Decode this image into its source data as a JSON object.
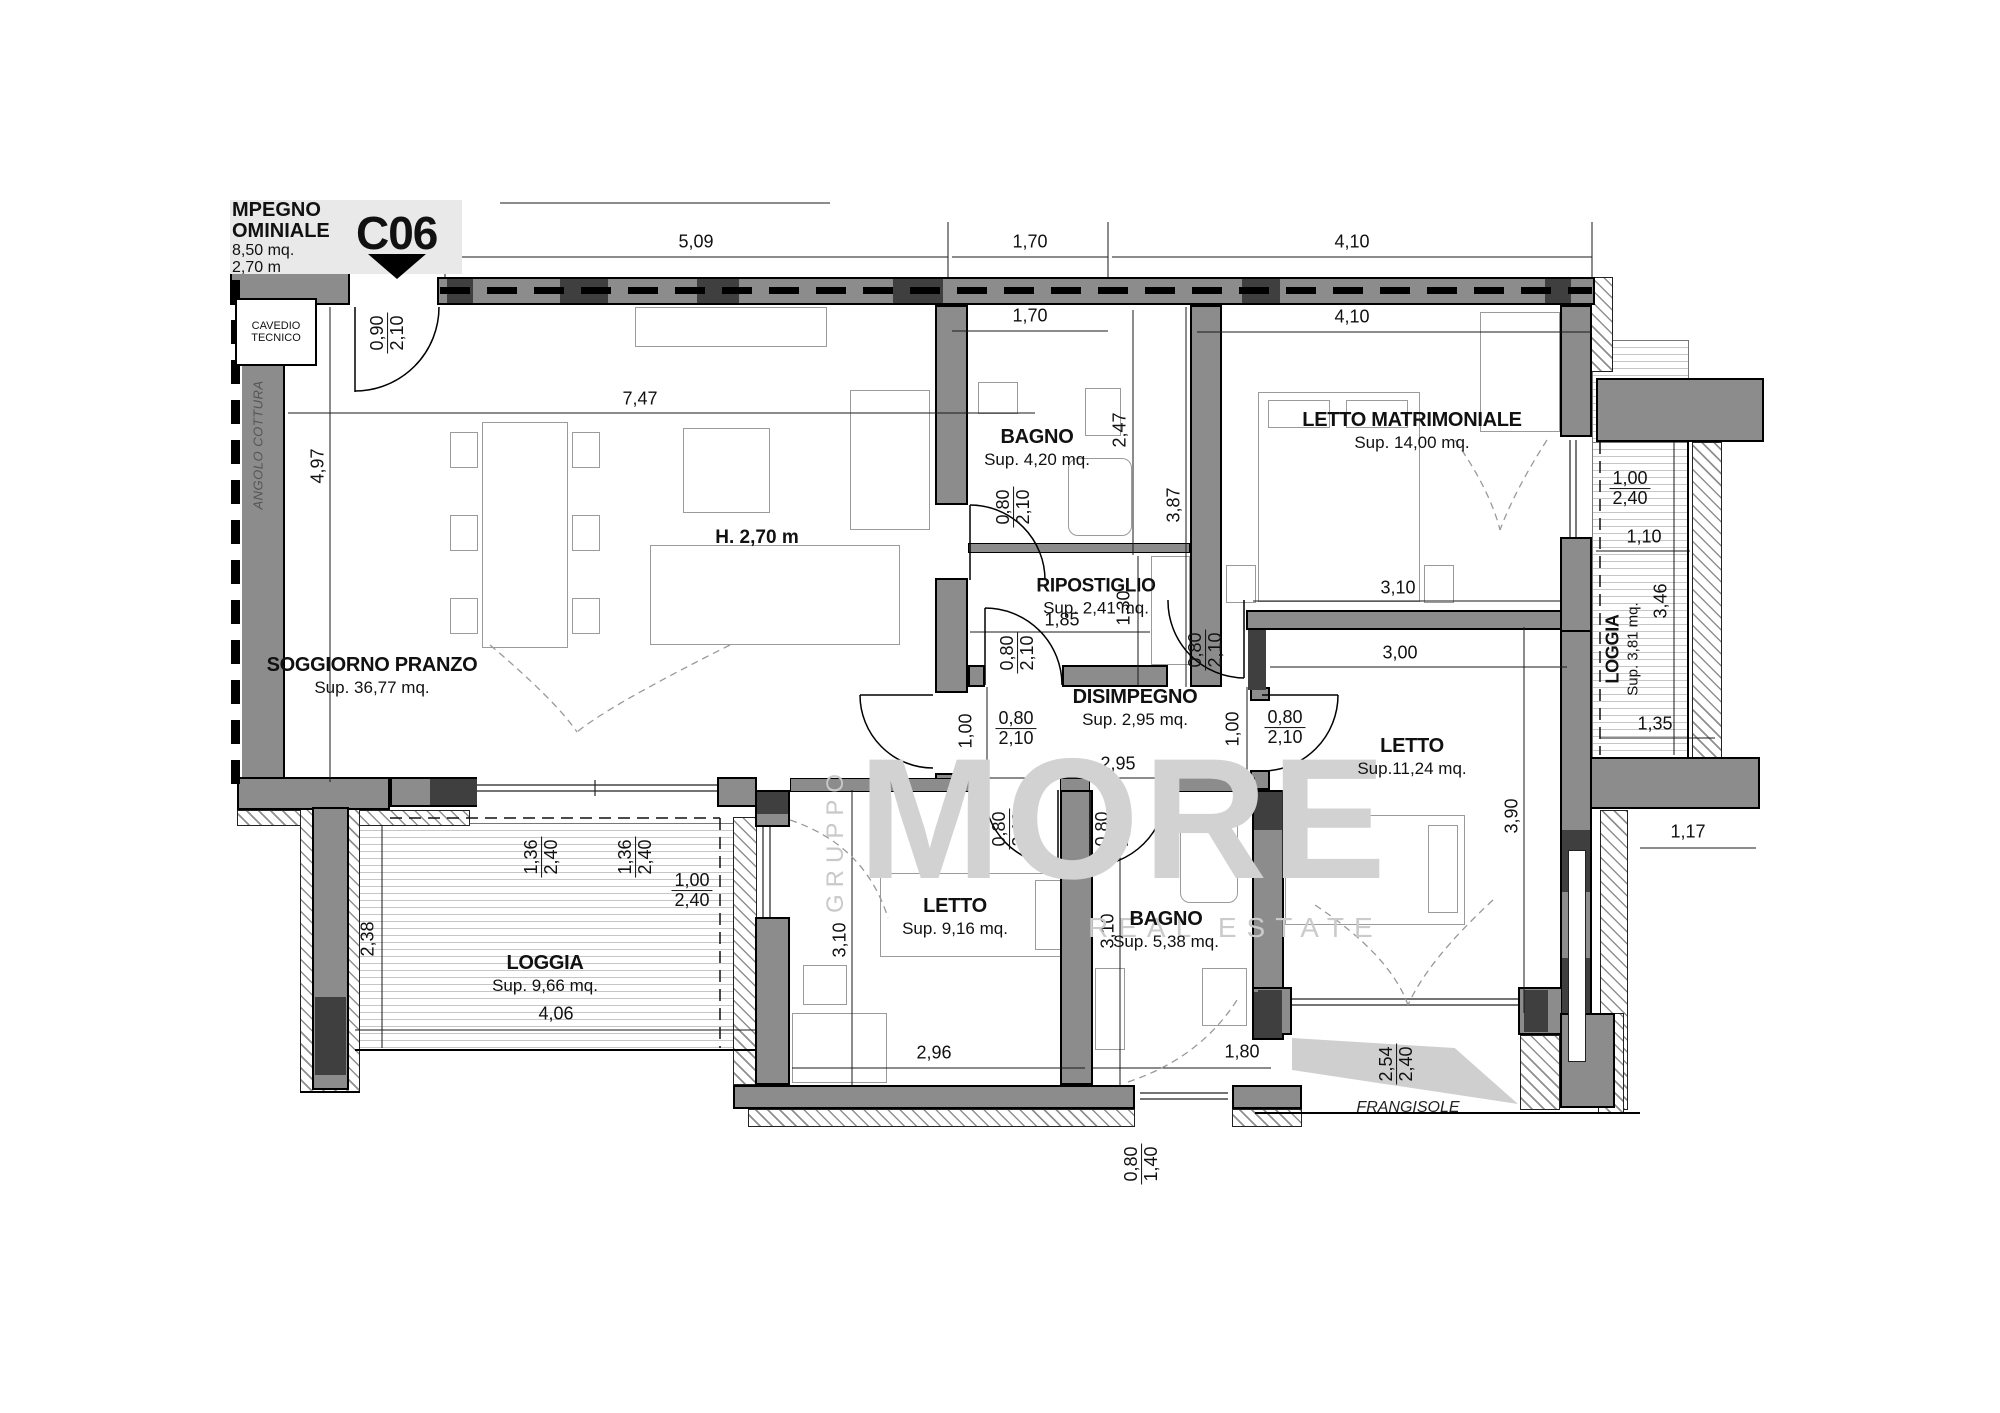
{
  "title_block": {
    "clipped_line1": "MPEGNO",
    "clipped_line2": "OMINIALE",
    "clipped_line3": "8,50 mq.",
    "clipped_line4": "2,70 m",
    "unit_code": "C06"
  },
  "cavedio": {
    "line1": "CAVEDIO",
    "line2": "TECNICO"
  },
  "watermark": {
    "side": "GRUPPO",
    "brand": "MORE",
    "tagline": "REAL ESTATE"
  },
  "notes": {
    "height": "H. 2,70 m",
    "angolo_cottura": "ANGOLO COTTURA",
    "frangisole": "FRANGISOLE"
  },
  "rooms": {
    "soggiorno": {
      "name": "SOGGIORNO PRANZO",
      "area": "Sup. 36,77 mq."
    },
    "bagno_servizio": {
      "name": "BAGNO",
      "area": "Sup. 4,20 mq."
    },
    "ripostiglio": {
      "name": "RIPOSTIGLIO",
      "area": "Sup. 2,41 mq."
    },
    "disimpegno": {
      "name": "DISIMPEGNO",
      "area": "Sup. 2,95 mq."
    },
    "letto_matrimoniale": {
      "name": "LETTO MATRIMONIALE",
      "area": "Sup. 14,00 mq."
    },
    "letto_medio": {
      "name": "LETTO",
      "area": "Sup.11,24 mq."
    },
    "letto_piccolo": {
      "name": "LETTO",
      "area": "Sup. 9,16 mq."
    },
    "bagno_notte": {
      "name": "BAGNO",
      "area": "Sup. 5,38 mq."
    },
    "loggia_sud": {
      "name": "LOGGIA",
      "area": "Sup. 9,66 mq."
    },
    "loggia_est": {
      "name": "LOGGIA",
      "area": "Sup. 3,81 mq."
    }
  },
  "dims": {
    "top_509": "5,09",
    "top_170_a": "1,70",
    "top_170_b": "1,70",
    "top_410_a": "4,10",
    "top_410_b": "4,10",
    "soggiorno_w": "7,47",
    "soggiorno_h": "4,97",
    "bagno_servizio_h": "2,47",
    "ripostiglio_w": "1,85",
    "ripostiglio_h": "1,30",
    "disimpegno_w": "2,95",
    "disimpegno_h_a": "1,00",
    "disimpegno_h_b": "1,00",
    "letto_matrimoniale_h": "3,87",
    "letto_matrimoniale_w": "3,10",
    "letto_medio_w": "3,00",
    "letto_medio_h": "3,90",
    "letto_piccolo_h": "3,10",
    "letto_piccolo_w": "2,96",
    "bagno_notte_h": "3,10",
    "bagno_notte_w": "1,80",
    "loggia_sud_h": "2,38",
    "loggia_sud_w": "4,06",
    "loggia_est_w": "1,10",
    "loggia_est_h": "3,46",
    "loggia_est_b": "1,35",
    "right_offset": "1,17"
  },
  "doors": {
    "entry": {
      "w": "0,90",
      "h": "2,10"
    },
    "bagno_servizio": {
      "w": "0,80",
      "h": "2,10"
    },
    "ripostiglio": {
      "w": "0,80",
      "h": "2,10"
    },
    "soggiorno_disimpegno": {
      "w": "0,80",
      "h": "2,10"
    },
    "letto_matrimoniale": {
      "w": "0,80",
      "h": "2,10"
    },
    "letto_medio": {
      "w": "0,80",
      "h": "2,10"
    },
    "letto_piccolo": {
      "w": "0,80",
      "h": "2,10"
    },
    "bagno_notte": {
      "w": "0,80",
      "h": "2,10"
    }
  },
  "windows": {
    "loggia_sud_1": {
      "w": "1,36",
      "h": "2,40"
    },
    "loggia_sud_2": {
      "w": "1,36",
      "h": "2,40"
    },
    "loggia_sud_3": {
      "w": "1,00",
      "h": "2,40"
    },
    "loggia_est": {
      "w": "1,00",
      "h": "2,40"
    },
    "bagno_notte": {
      "w": "0,80",
      "h": "1,40"
    },
    "frangisole": {
      "w": "2,54",
      "h": "2,40"
    }
  }
}
